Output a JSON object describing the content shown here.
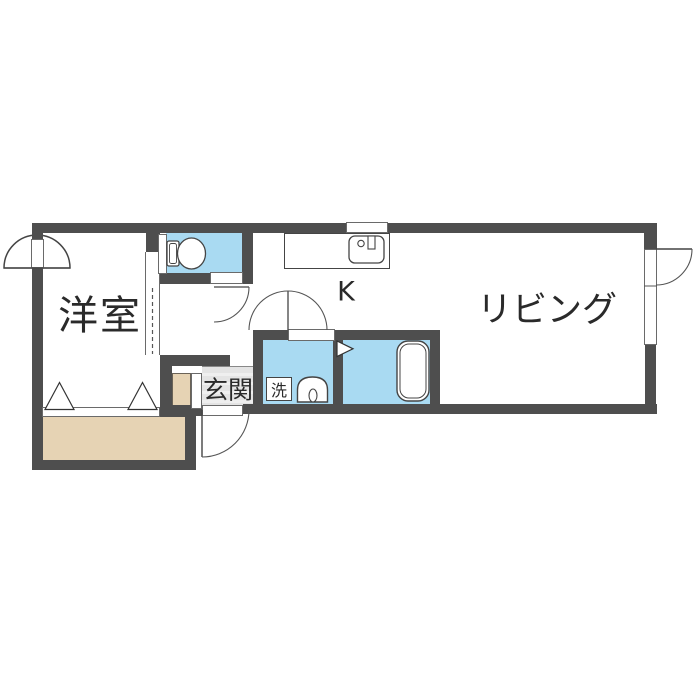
{
  "colors": {
    "wall": "#4e4e4e",
    "water": "#a9daf2",
    "balcony": "#e6d3b4",
    "tile": "#e4e4e4",
    "line": "#444444",
    "text": "#2a2a2a"
  },
  "rooms": {
    "western": {
      "label": "洋室"
    },
    "living": {
      "label": "リビング"
    },
    "kitchen": {
      "label": "K"
    },
    "entrance": {
      "label": "玄関"
    },
    "laundry": {
      "label": "洗"
    }
  }
}
